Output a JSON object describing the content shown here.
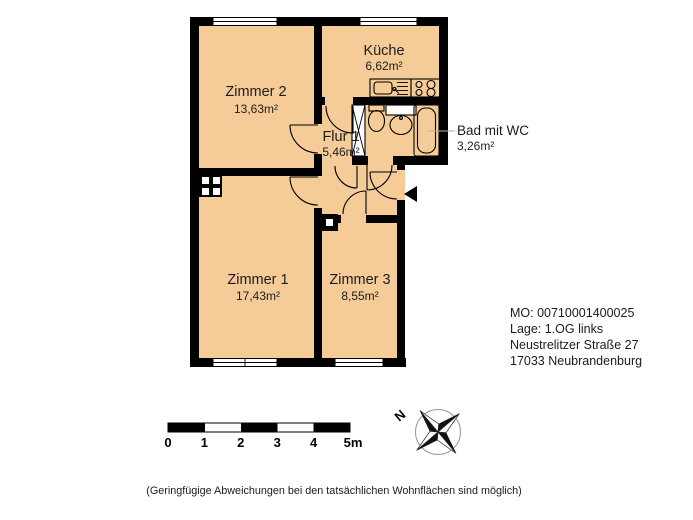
{
  "floor_plan": {
    "rooms": {
      "zimmer2": {
        "name": "Zimmer 2",
        "area": "13,63m²"
      },
      "kueche": {
        "name": "Küche",
        "area": "6,62m²"
      },
      "flur": {
        "name": "Flur 1",
        "area": "5,46m²"
      },
      "bad": {
        "name": "Bad mit WC",
        "area": "3,26m²"
      },
      "zimmer1": {
        "name": "Zimmer 1",
        "area": "17,43m²"
      },
      "zimmer3": {
        "name": "Zimmer 3",
        "area": "8,55m²"
      }
    },
    "fixture_icons": [
      "kitchen-sink-icon",
      "stove-icon",
      "toilet-icon",
      "washbasin-icon",
      "bathtub-icon",
      "shaft-icon",
      "chimney-icon",
      "entrance-arrow-icon"
    ]
  },
  "info_block": {
    "line1": "MO: 00710001400025",
    "line2": "Lage: 1.OG links",
    "line3": "Neustrelitzer Straße 27",
    "line4": "17033 Neubrandenburg"
  },
  "scale_bar": {
    "labels": [
      "0",
      "1",
      "2",
      "3",
      "4",
      "5m"
    ]
  },
  "compass": {
    "north_label": "N"
  },
  "disclaimer": "(Geringfügige Abweichungen bei den tatsächlichen Wohnflächen sind möglich)",
  "colors": {
    "room_fill": "#f5cc98",
    "wall": "#000000",
    "leader_line": "#b3b3b3",
    "text": "#1c1c1c",
    "compass_ring": "#999999"
  }
}
